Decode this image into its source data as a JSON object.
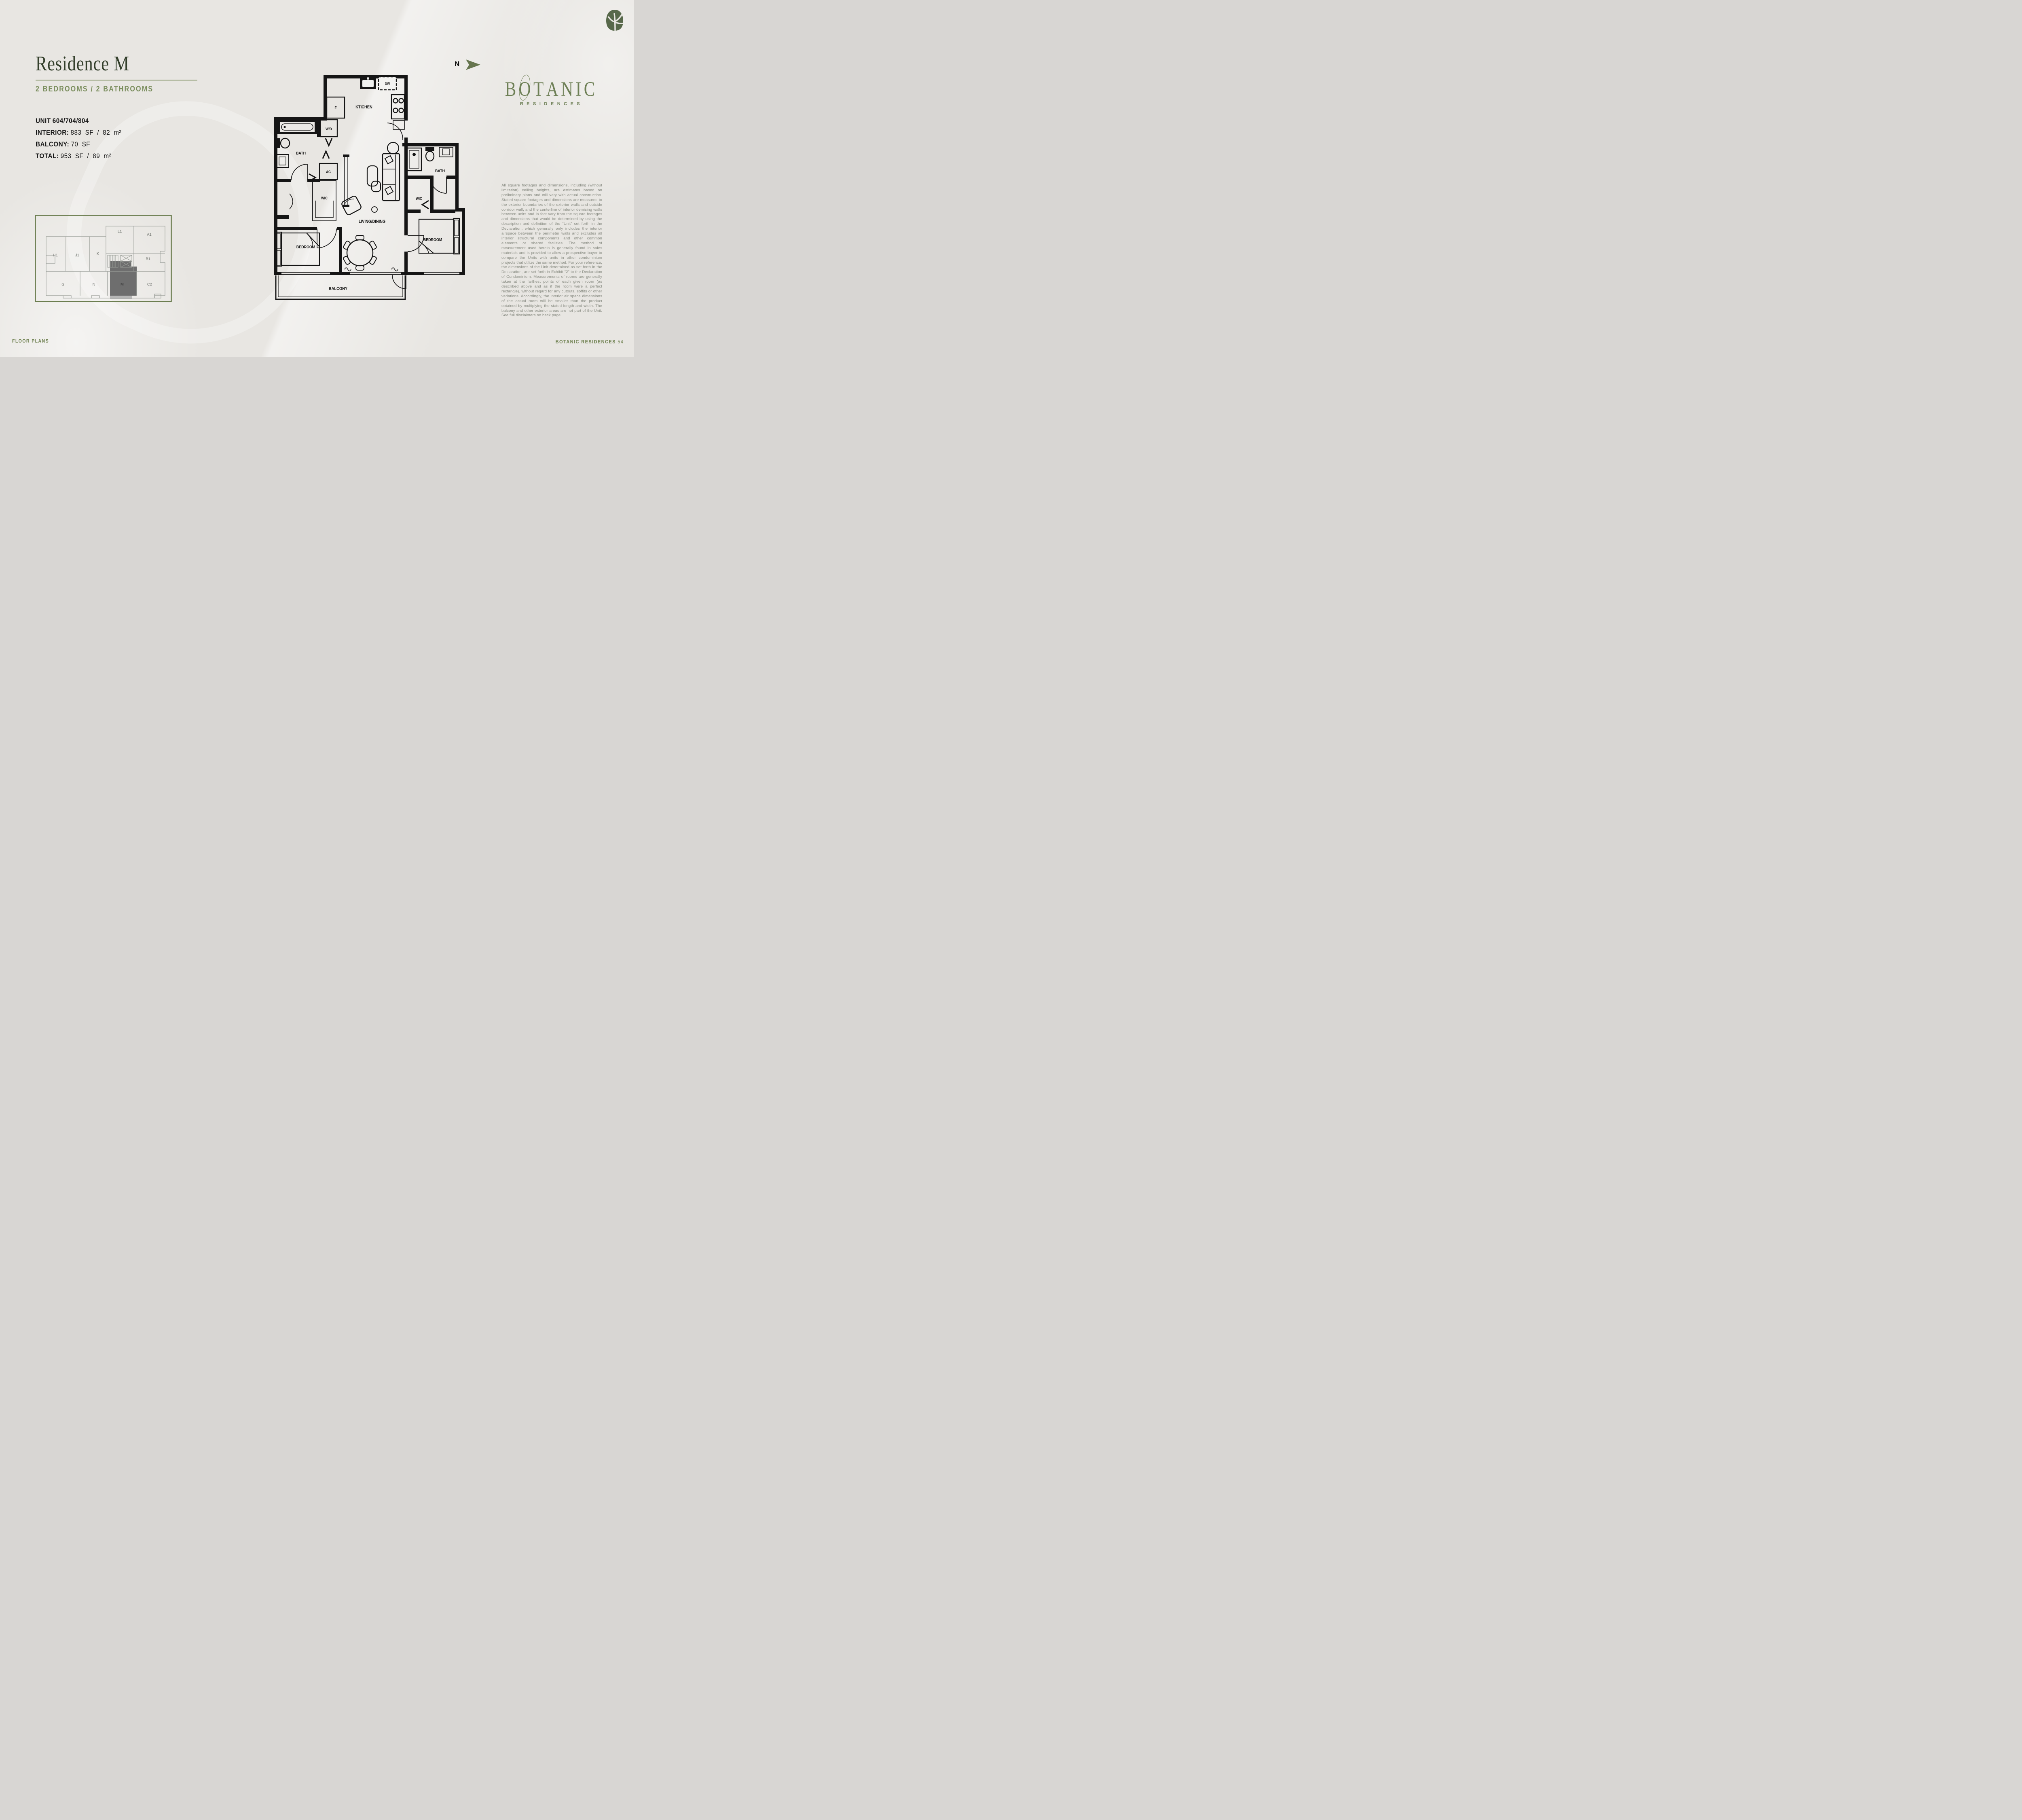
{
  "header": {
    "title": "Residence M",
    "subtitle": "2 BEDROOMS / 2 BATHROOMS"
  },
  "unit_info": {
    "rows": [
      {
        "label": "UNIT",
        "value": "604/704/804"
      },
      {
        "label": "INTERIOR:",
        "value": "883 SF / 82 m²"
      },
      {
        "label": "BALCONY:",
        "value": "70 SF"
      },
      {
        "label": "TOTAL:",
        "value": "953 SF / 89 m²"
      }
    ]
  },
  "north": {
    "label": "N"
  },
  "logo": {
    "letters": [
      "B",
      "O",
      "T",
      "A",
      "N",
      "I",
      "C"
    ],
    "subtitle": "RESIDENCES"
  },
  "floorplan": {
    "labels": {
      "kitchen": "KTICHEN",
      "dishwasher": "DW",
      "fridge": "F",
      "washer_dryer": "W/D",
      "ac": "AC",
      "bath_left": "BATH",
      "wic_left": "WIC",
      "living_dining": "LIVING/DINING",
      "bedroom_left": "BEDROOM",
      "bedroom_right": "BEDROOM",
      "bath_right": "BATH",
      "wic_right": "WIC",
      "balcony": "BALCONY"
    }
  },
  "keyplan": {
    "units": {
      "h1": "H1",
      "j1": "J1",
      "k": "K",
      "l1": "L1",
      "a1": "A1",
      "b1": "B1",
      "g": "G",
      "n": "N",
      "m": "M",
      "c2": "C2"
    },
    "highlighted_unit": "M"
  },
  "disclaimer": {
    "text": "All square footages and dimensions, including (without limitation) ceiling heights, are estimates based on preliminary plans and will vary with actual construction. Stated square footages and dimensions are measured to the exterior boundaries of the exterior walls and outside corridor wall, and the centerline of interior demising walls between units and in fact vary from the square footages and dimensions that would be determined by using the description and definition of the “Unit” set forth in the Declaration, which generally only includes the interior airspace between the perimeter walls and excludes all interior structural components and other common elements or shared facilities.  The method of measurement used herein is generally found in sales materials and is provided to allow a prospective buyer to compare the Units with units in other condominium projects that utilize the same method. For your reference, the dimensions of the Unit determined as set forth in the Declaration, are set forth in Exhibit “2” to the Declaration of Condominium. Measurements of rooms are generally taken at the farthest points of each given room (as described above and as if the room were a perfect rectangle), without regard for any cutouts, soffits or other variations.  Accordingly, the interior air space dimensions of the actual room will be smaller than the product obtained by multiplying the stated length and width.  The balcony and other exterior areas are not part of the Unit. See full disclaimers on back page"
  },
  "footer": {
    "left": "FLOOR PLANS",
    "brand": "BOTANIC RESIDENCES",
    "page": "54"
  },
  "colors": {
    "background": "#e8e6e2",
    "title_green": "#333f2b",
    "accent_olive": "#7b8e5e",
    "logo_green": "#6d7f55",
    "footer_green": "#6f8150",
    "disclaimer_gray": "#8b8e85",
    "plan_black": "#151515",
    "keyplan_border": "#6b7d4f",
    "keyplan_line": "#989c96",
    "keyplan_highlight_fill": "#6e6e6e",
    "keyplan_balcony_fill": "#b7b7b7"
  }
}
